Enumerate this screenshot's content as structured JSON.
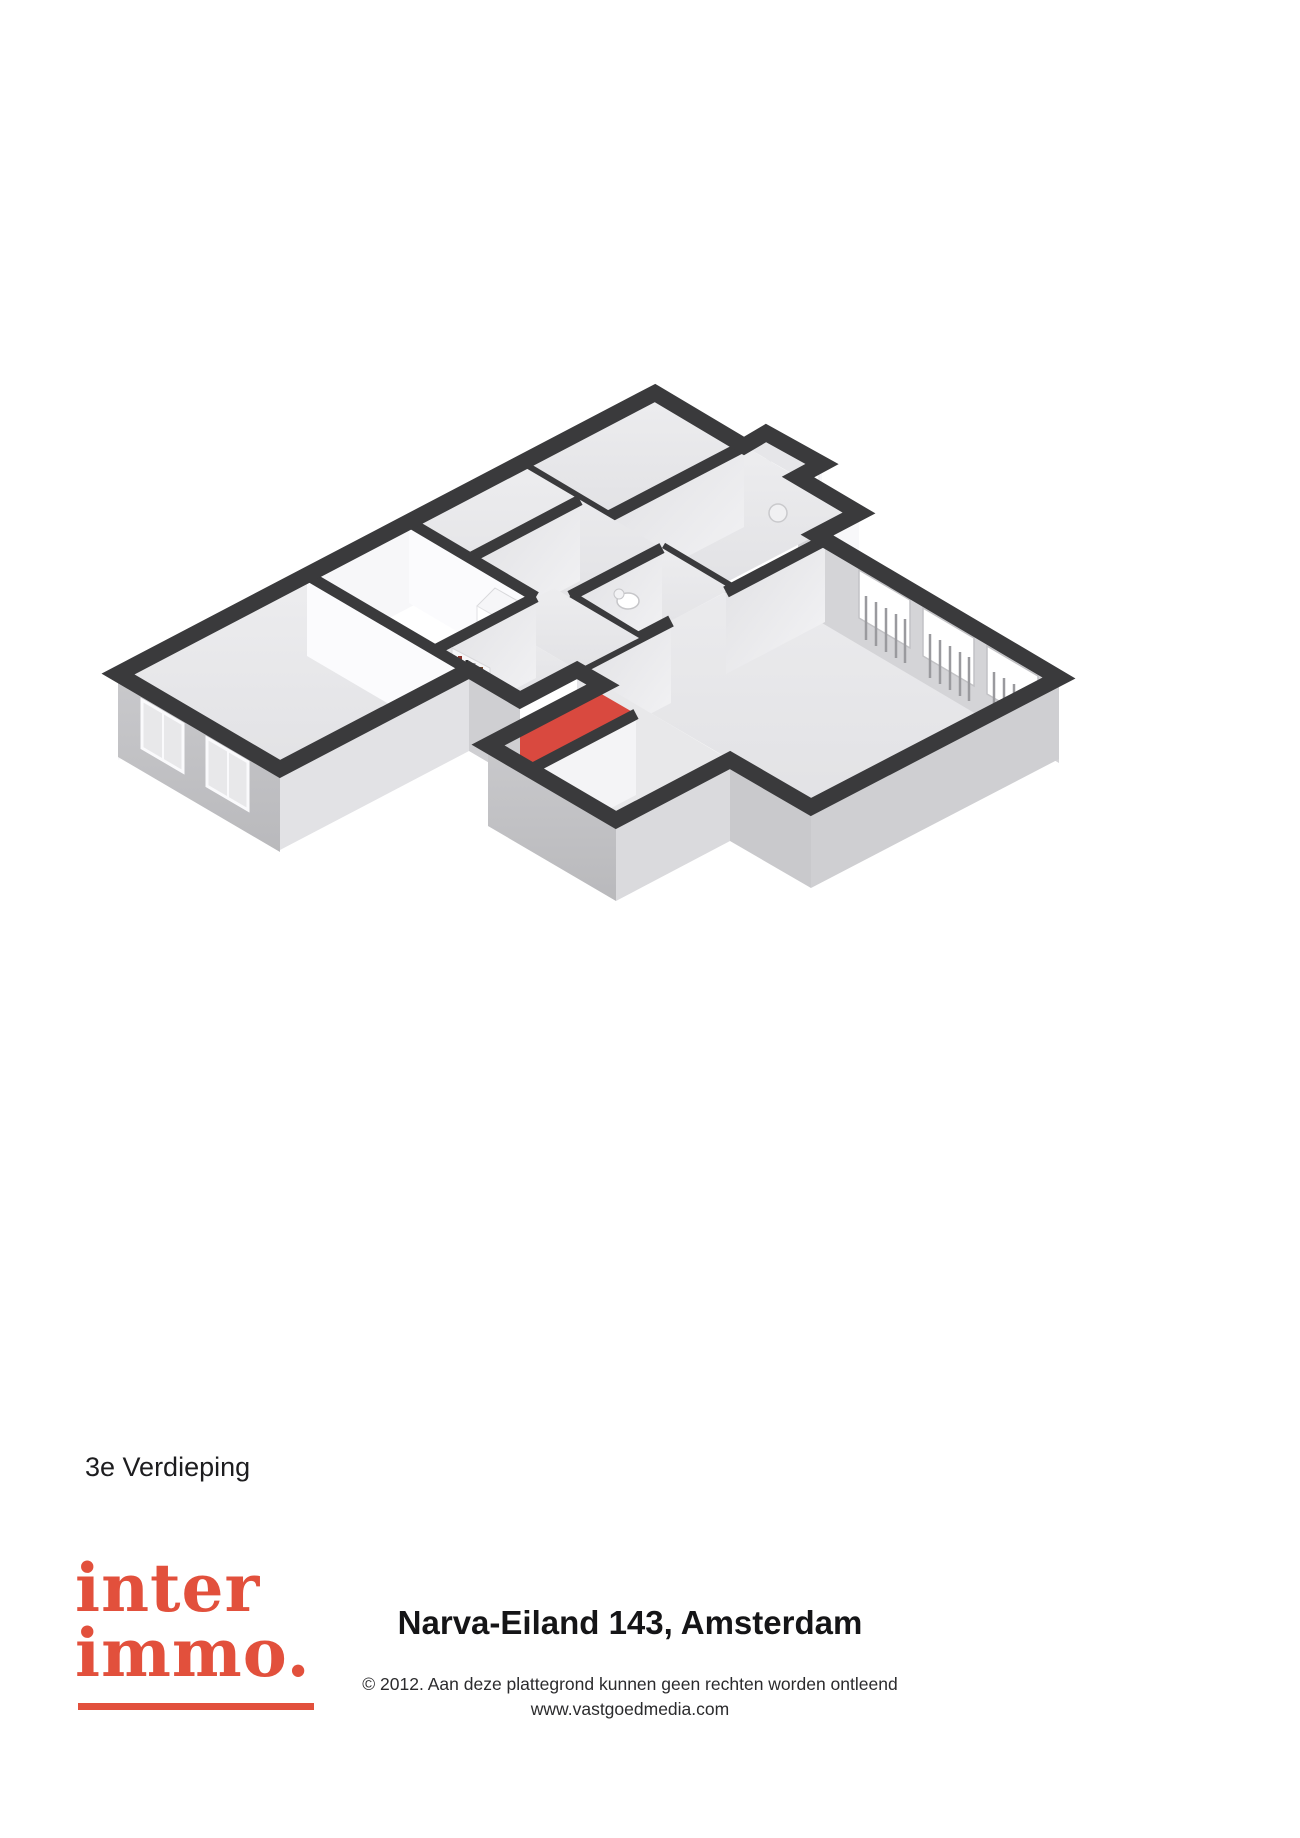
{
  "page": {
    "background": "#ffffff",
    "width": 1300,
    "height": 1838
  },
  "floorplan": {
    "floor_label": "3e Verdieping",
    "view": "3d-isometric",
    "colors": {
      "wall_top": "#3a3a3c",
      "floor": "#eaeaec",
      "interior_face_light": "#fbfbfd",
      "interior_face_shade": "#d3d3d6",
      "exterior_face": "#c6c6c9",
      "accent_floor": "#d9493f",
      "window_glass": "#ffffff"
    }
  },
  "footer": {
    "logo": {
      "word1": "inter",
      "word2": "immo.",
      "color": "#e2503c"
    },
    "address_title": "Narva-Eiland 143, Amsterdam",
    "disclaimer": "© 2012. Aan deze plattegrond kunnen geen rechten worden ontleend",
    "website": "www.vastgoedmedia.com"
  }
}
